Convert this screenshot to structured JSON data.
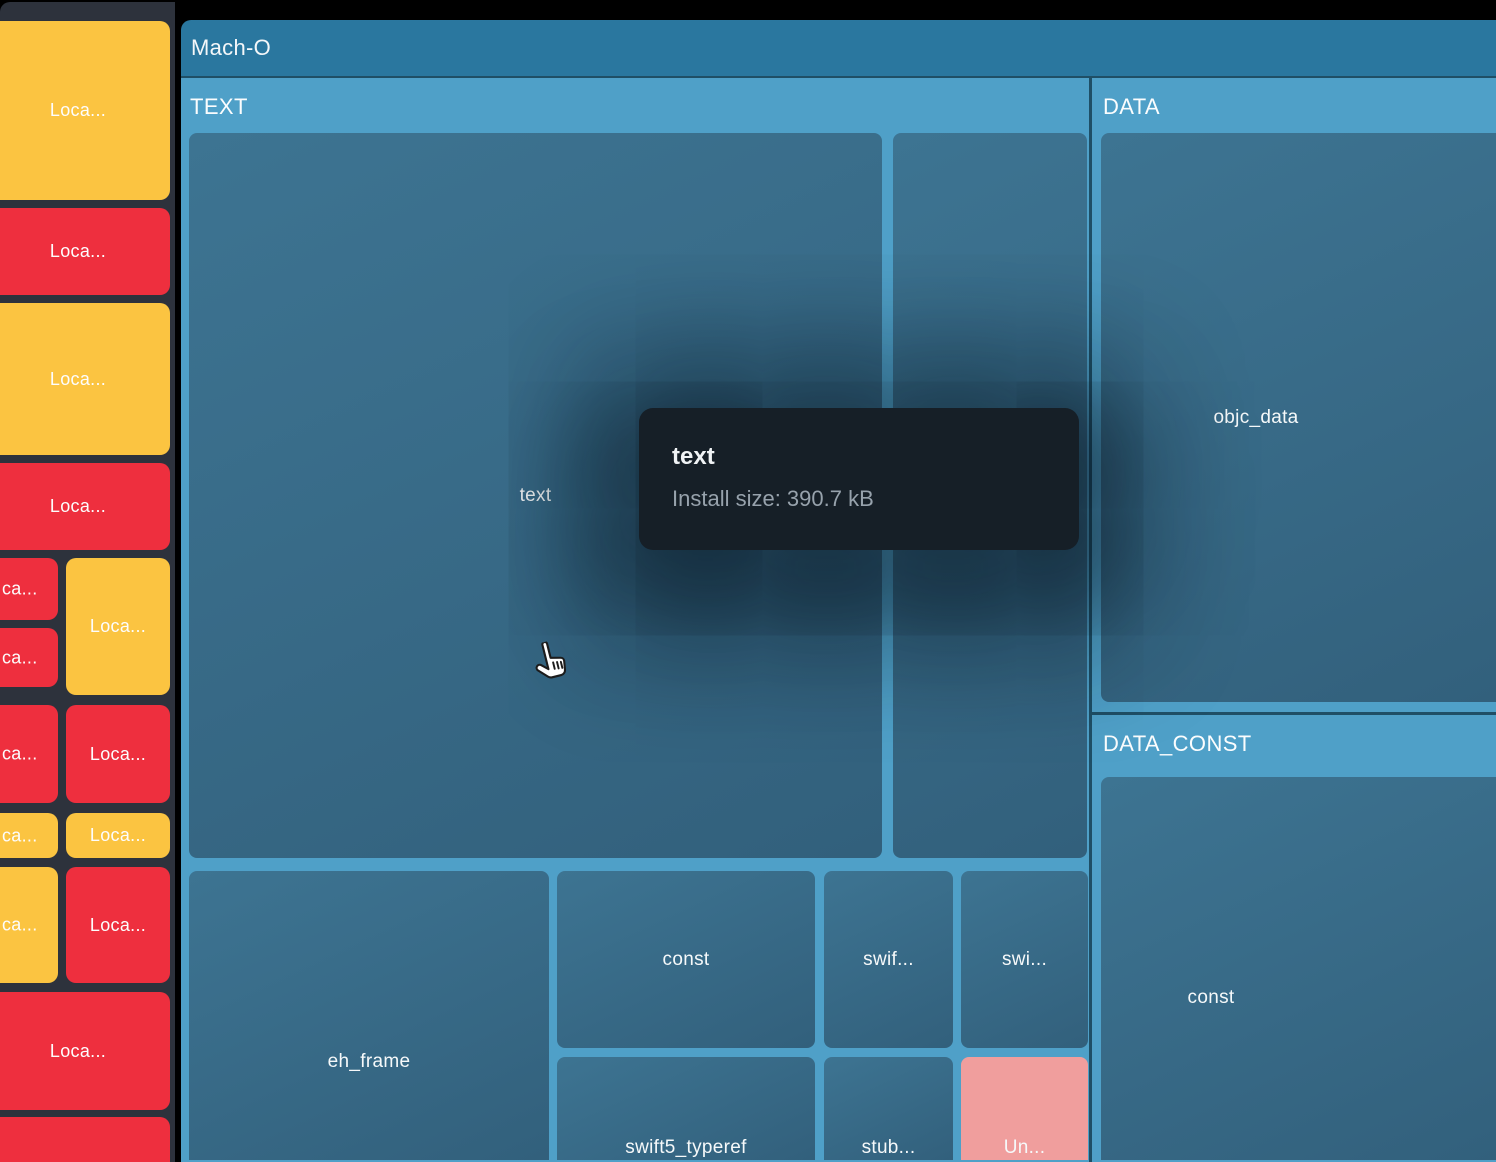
{
  "window": {
    "root_label": "Mach-O"
  },
  "sidebar": {
    "items": [
      {
        "label": "Loca..."
      },
      {
        "label": "Loca..."
      },
      {
        "label": "Loca..."
      },
      {
        "label": "Loca..."
      },
      {
        "label": "ca..."
      },
      {
        "label": "ca..."
      },
      {
        "label": "Loca..."
      },
      {
        "label": "ca..."
      },
      {
        "label": "Loca..."
      },
      {
        "label": "ca..."
      },
      {
        "label": "Loca..."
      },
      {
        "label": "ca..."
      },
      {
        "label": "Loca..."
      },
      {
        "label": "Loca..."
      },
      {
        "label": ""
      }
    ]
  },
  "treemap": {
    "sections": {
      "text": {
        "label": "TEXT",
        "blocks": {
          "text": {
            "label": "text"
          },
          "column": {
            "label": ""
          },
          "eh_frame": {
            "label": "eh_frame"
          },
          "const_block": {
            "label": "const"
          },
          "swif": {
            "label": "swif..."
          },
          "swi": {
            "label": "swi..."
          },
          "swift5_typeref": {
            "label": "swift5_typeref"
          },
          "stub": {
            "label": "stub..."
          },
          "un": {
            "label": "Un..."
          }
        }
      },
      "data": {
        "label": "DATA",
        "blocks": {
          "objc_data": {
            "label": "objc_data"
          }
        }
      },
      "data_const": {
        "label": "DATA_CONST",
        "blocks": {
          "const_block": {
            "label": "const"
          }
        }
      }
    }
  },
  "tooltip": {
    "title": "text",
    "size_label": "Install size: 390.7 kB"
  },
  "cursor": {
    "type": "hand-pointer"
  },
  "colors": {
    "yellow": "#fbc441",
    "red": "#ee2f3e",
    "pink": "#f09e9d",
    "section_blue": "#4fa0c8",
    "header_blue": "#2a779f",
    "teal_a": "#3d7492",
    "teal_b": "#32607c",
    "divider": "#1f4f66",
    "sidebar_bg": "#2d323c",
    "tooltip_bg": "#161f27",
    "tooltip_text_secondary": "#97a2ac"
  }
}
